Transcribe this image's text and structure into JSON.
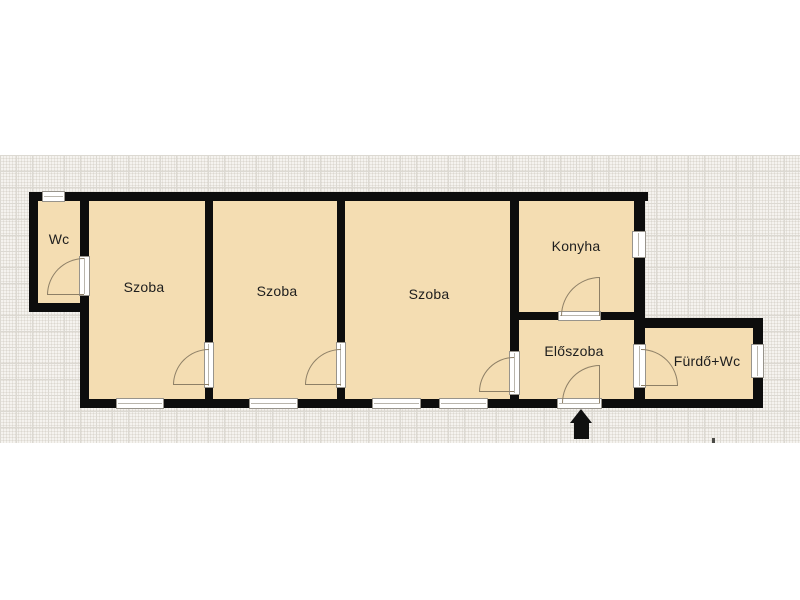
{
  "floorplan": {
    "rooms": [
      {
        "id": "wc",
        "label": "Wc"
      },
      {
        "id": "szoba-1",
        "label": "Szoba"
      },
      {
        "id": "szoba-2",
        "label": "Szoba"
      },
      {
        "id": "szoba-3",
        "label": "Szoba"
      },
      {
        "id": "konyha",
        "label": "Konyha"
      },
      {
        "id": "eloszoba",
        "label": "Előszoba"
      },
      {
        "id": "furdo-wc",
        "label": "Fürdő+Wc"
      }
    ],
    "entrance_indicator": "arrow-up",
    "colors": {
      "room_fill": "#f4ddb2",
      "wall": "#0d0d0d",
      "grid_background": "#f5f3ef",
      "door_arc": "#8d7f66",
      "window_frame": "#98948c"
    }
  }
}
